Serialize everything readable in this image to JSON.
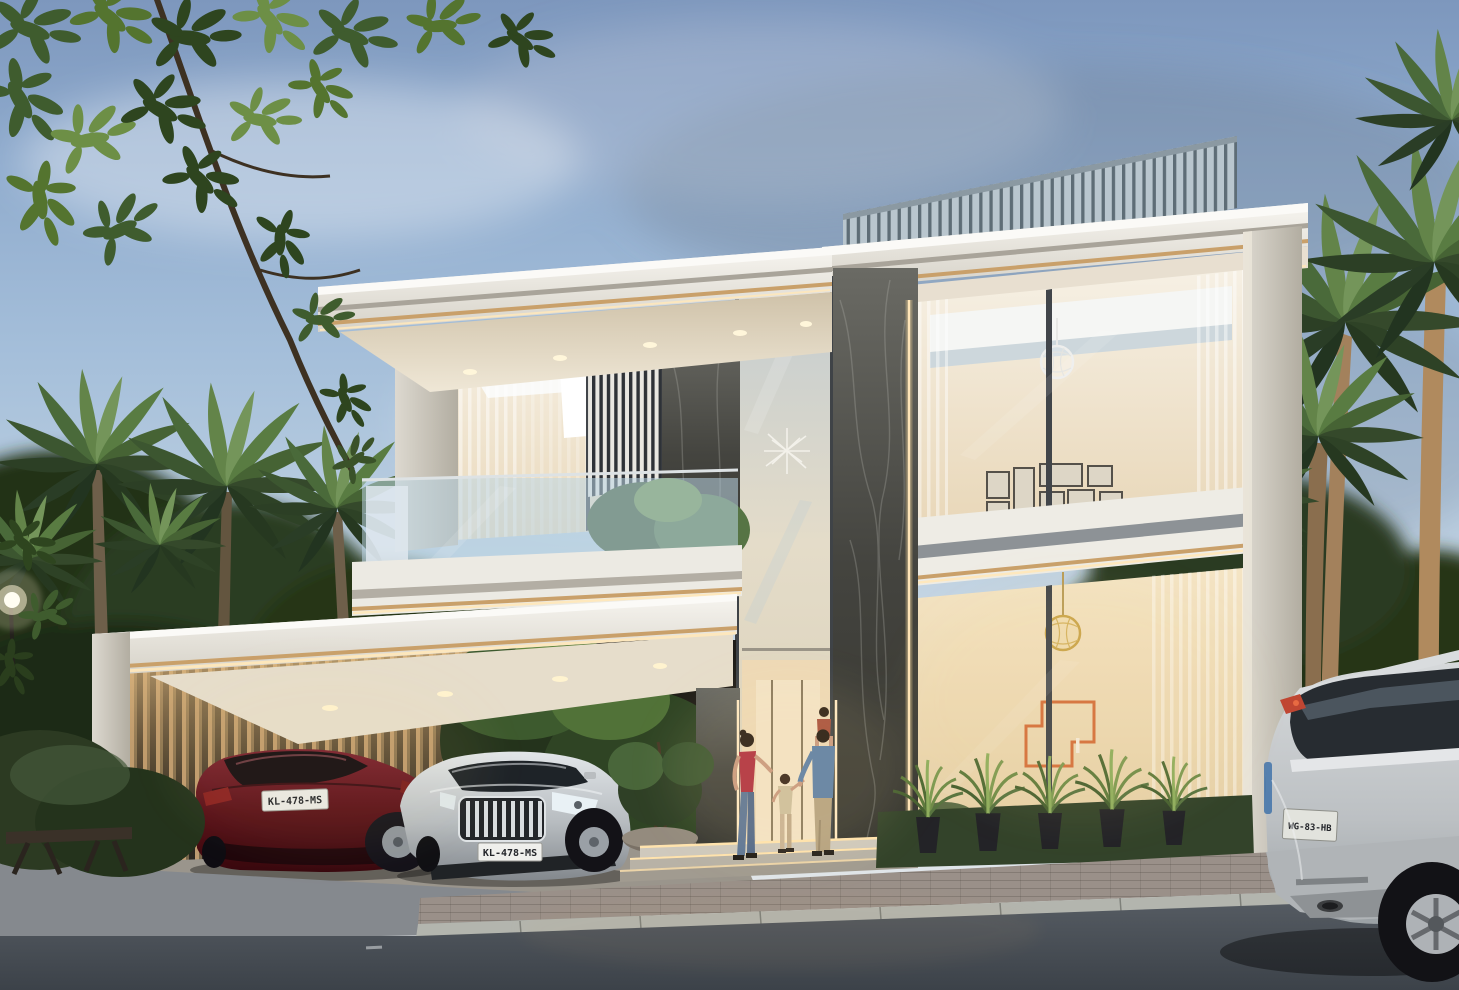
{
  "scene": {
    "title": "Modern luxury villa exterior rendering at dusk",
    "setting": "Two-storey white contemporary villa with glass facades, warm interior lighting, rooftop louvre screen, dark marble entrance walls, carport with two sedans, family at the door, tropical palms and landscaping, grey SUV in the right foreground",
    "time_of_day": "dusk"
  },
  "vehicles": {
    "red_sedan": {
      "description": "dark red sedan in carport, rear view",
      "plate": "KL-478-MS"
    },
    "silver_sedan": {
      "description": "silver sedan in carport, front view",
      "plate": "KL-478-MS"
    },
    "suv": {
      "description": "light grey SUV in right foreground, rear view",
      "plate": "WG-83-HB"
    }
  },
  "people": [
    {
      "label": "woman in red top and jeans walking toward entrance"
    },
    {
      "label": "toddler holding hands"
    },
    {
      "label": "man in blue shirt with child on his shoulders"
    }
  ],
  "palette": {
    "sky_top": "#7d97bd",
    "sky_horizon": "#e3e7ea",
    "building_white": "#f2f0ea",
    "soffit_wood": "#d9cdb9",
    "marble_dark": "#45453f",
    "led_warm": "#ffe8bc",
    "gold_trim": "#c9a06a",
    "foliage_dark": "#26351d",
    "palm_green": "#4a6a3c",
    "grass": "#33432a",
    "asphalt": "#464c53",
    "car_red": "#5a1018",
    "car_silver": "#c6cacd",
    "suv_grey": "#c3c7ca",
    "art_orange": "#d4703c"
  }
}
